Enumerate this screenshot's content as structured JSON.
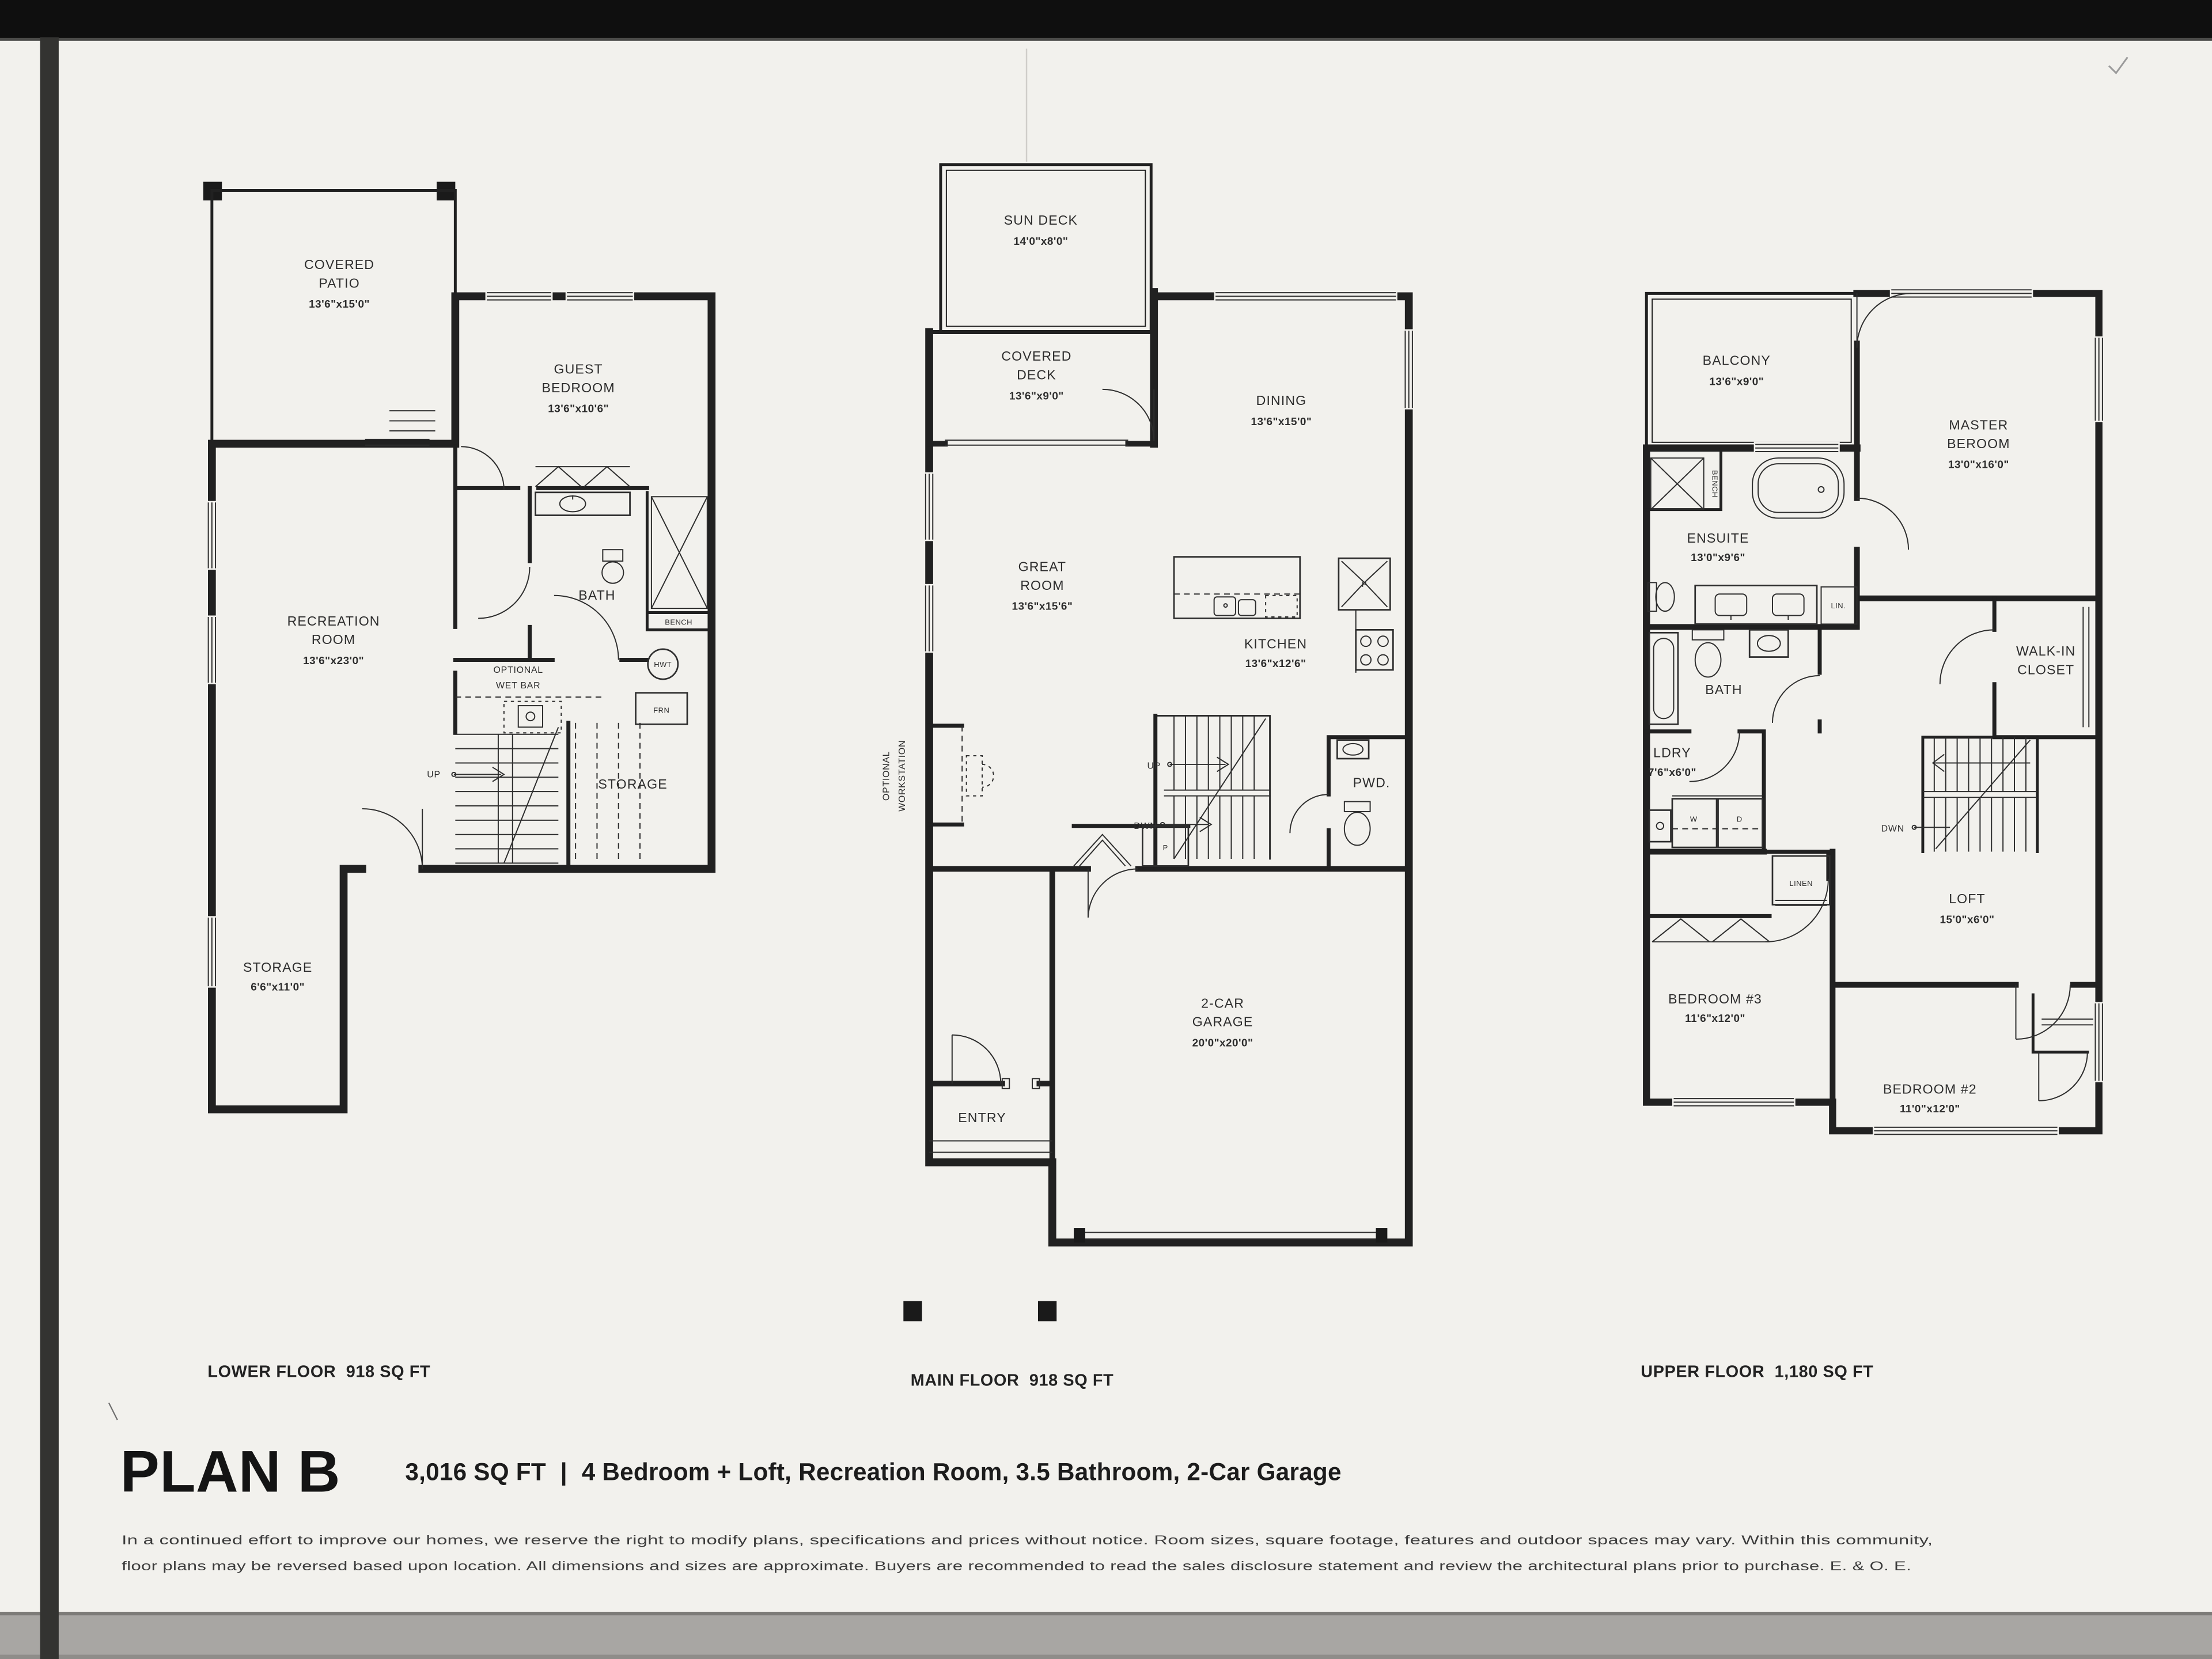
{
  "colors": {
    "page_bg": "#f2f1ed",
    "ink": "#212121",
    "scan_top_bar": "#0f0f0f",
    "scan_left_strip": "#333333",
    "scan_bottom_strip": "#a8a6a3"
  },
  "title": {
    "plan_name": "PLAN B",
    "area": "3,016 SQ FT",
    "separator": "|",
    "features": "4 Bedroom + Loft, Recreation Room, 3.5 Bathroom, 2-Car Garage"
  },
  "disclaimer": {
    "line1": "In a continued effort to improve our homes, we reserve the right to modify plans, specifications and prices without notice. Room sizes, square footage, features and outdoor spaces may vary. Within this community,",
    "line2": "floor plans may be reversed based upon location. All dimensions and sizes are approximate. Buyers are recommended to read the sales disclosure statement and review the architectural plans prior to purchase. E. & O. E."
  },
  "floors": {
    "lower": {
      "caption_name": "LOWER FLOOR",
      "caption_area": "918 SQ FT",
      "covered_patio": {
        "l1": "COVERED",
        "l2": "PATIO",
        "dims": "13'6\"x15'0\""
      },
      "guest_bedroom": {
        "l1": "GUEST",
        "l2": "BEDROOM",
        "dims": "13'6\"x10'6\""
      },
      "recreation_room": {
        "l1": "RECREATION",
        "l2": "ROOM",
        "dims": "13'6\"x23'0\""
      },
      "bath": "BATH",
      "bench": "BENCH",
      "wet_bar": {
        "l1": "OPTIONAL",
        "l2": "WET BAR"
      },
      "hwt": "HWT",
      "frn": "FRN",
      "up": "UP",
      "storage_main": "STORAGE",
      "storage_lower": {
        "l1": "STORAGE",
        "dims": "6'6\"x11'0\""
      }
    },
    "main": {
      "caption_name": "MAIN FLOOR",
      "caption_area": "918 SQ FT",
      "sun_deck": {
        "l1": "SUN DECK",
        "dims": "14'0\"x8'0\""
      },
      "covered_deck": {
        "l1": "COVERED",
        "l2": "DECK",
        "dims": "13'6\"x9'0\""
      },
      "dining": {
        "l1": "DINING",
        "dims": "13'6\"x15'0\""
      },
      "great_room": {
        "l1": "GREAT",
        "l2": "ROOM",
        "dims": "13'6\"x15'6\""
      },
      "kitchen": {
        "l1": "KITCHEN",
        "dims": "13'6\"x12'6\""
      },
      "pwd": "PWD.",
      "garage": {
        "l1": "2-CAR",
        "l2": "GARAGE",
        "dims": "20'0\"x20'0\""
      },
      "entry": "ENTRY",
      "workstation": {
        "l1": "OPTIONAL",
        "l2": "WORKSTATION"
      },
      "up": "UP",
      "dwn": "DWN",
      "pantry": "P"
    },
    "upper": {
      "caption_name": "UPPER FLOOR",
      "caption_area": "1,180 SQ FT",
      "balcony": {
        "l1": "BALCONY",
        "dims": "13'6\"x9'0\""
      },
      "master": {
        "l1": "MASTER",
        "l2": "BEROOM",
        "dims": "13'0\"x16'0\""
      },
      "ensuite": {
        "l1": "ENSUITE",
        "dims": "13'0\"x9'6\""
      },
      "bench": "BENCH",
      "lin": "LIN.",
      "walk_in": {
        "l1": "WALK-IN",
        "l2": "CLOSET"
      },
      "bath": "BATH",
      "ldry": {
        "l1": "LDRY",
        "dims": "7'6\"x6'0\""
      },
      "washer": "W",
      "dryer": "D",
      "linen": "LINEN",
      "dwn": "DWN",
      "loft": {
        "l1": "LOFT",
        "dims": "15'0\"x6'0\""
      },
      "bedroom3": {
        "l1": "BEDROOM #3",
        "dims": "11'6\"x12'0\""
      },
      "bedroom2": {
        "l1": "BEDROOM #2",
        "dims": "11'0\"x12'0\""
      }
    }
  }
}
